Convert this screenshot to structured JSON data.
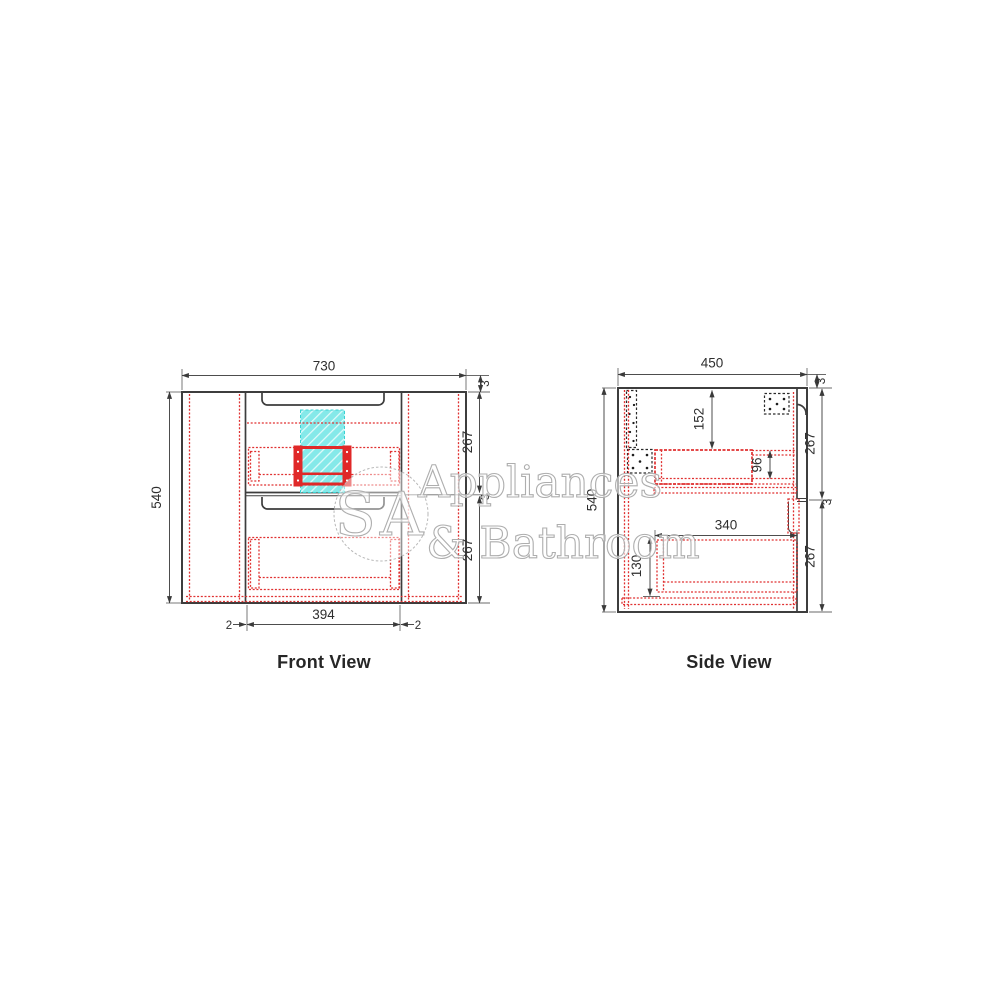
{
  "page": {
    "background": "#ffffff"
  },
  "drawing": {
    "front_view": {
      "label": "Front View",
      "dims": {
        "overall_width": "730",
        "overall_height": "540",
        "top_panel_thickness": "3",
        "upper_drawer_front_height": "267",
        "drawer_gap": "3",
        "lower_drawer_front_height": "267",
        "drawer_front_width": "394",
        "side_gap_left": "2",
        "side_gap_right": "2"
      }
    },
    "side_view": {
      "label": "Side View",
      "dims": {
        "overall_depth": "450",
        "overall_height": "540",
        "top_panel_thickness": "3",
        "upper_drawer_front_height": "267",
        "drawer_gap": "3",
        "lower_drawer_front_height": "267",
        "top_to_drawer_body": "152",
        "upper_drawer_side_height": "96",
        "lower_drawer_depth": "340",
        "lower_drawer_side_height": "130"
      }
    },
    "watermark": {
      "monogram": "SA",
      "line1": "Appliances",
      "line2": "& Bathroom"
    },
    "colors": {
      "line": "#3d3d3d",
      "dimension": "#4d4d4d",
      "hidden_red": "#e03131",
      "cutout_cyan": "#85e9e9",
      "watermark_gray": "#aeaeae"
    }
  }
}
